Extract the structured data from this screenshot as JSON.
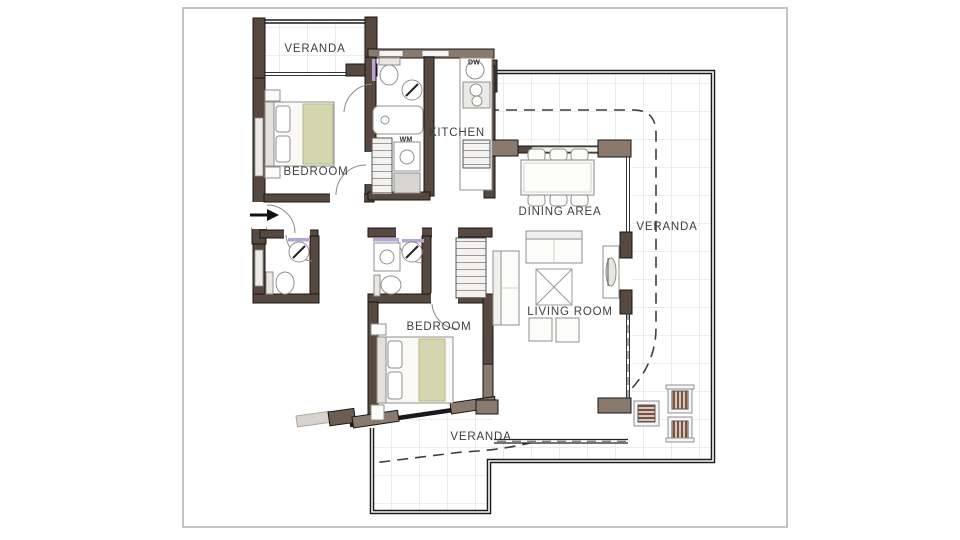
{
  "document": {
    "type": "apartment-floor-plan",
    "page_background": "#ffffff",
    "frame_color": "#c6c4c1"
  },
  "palette": {
    "wall_dark": "#57493f",
    "wall_light": "#8a7a6e",
    "outline_black": "#1a1a1a",
    "tile_line": "#d9d9d6",
    "furniture_line": "#8f8f8d",
    "blanket_green": "#d4d6ad",
    "outdoor_stripe_brown": "#7d4f3c",
    "fixture_accent_purple": "#b6a6d6",
    "dashed_line": "#3f3f3f",
    "label_color": "#3f3f3f"
  },
  "labels": {
    "veranda_top": "VERANDA",
    "kitchen": "KITCHEN",
    "bedroom_1": "BEDROOM",
    "dining_area": "DINING AREA",
    "veranda_right": "VERANDA",
    "living_room": "LIVING ROOM",
    "bedroom_2": "BEDROOM",
    "veranda_bottom": "VERANDA",
    "dishwasher": "DW",
    "washing_machine": "WM"
  }
}
